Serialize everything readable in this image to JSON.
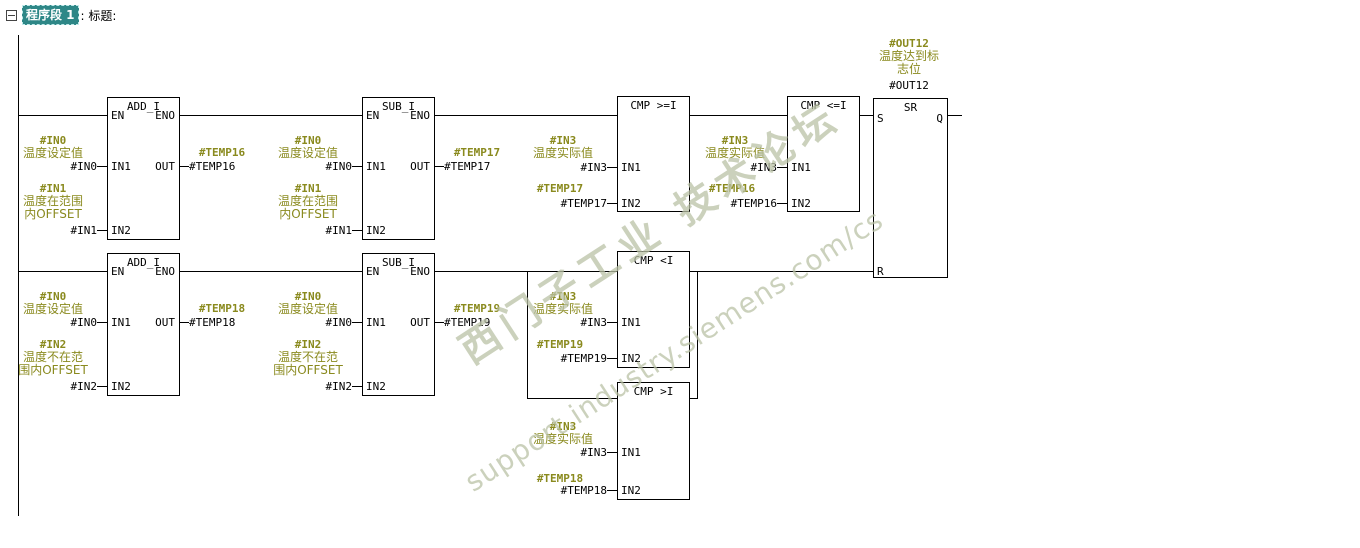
{
  "header": {
    "collapse_icon": "minus-box-icon",
    "network_label": "程序段 1",
    "suffix": ": 标题:"
  },
  "watermark": {
    "line1": "西门子工业 技术论坛",
    "line2": "support.industry.siemens.com/cs",
    "color": "#BAC1A5"
  },
  "colors": {
    "symbol_text": "#8A8A1E",
    "operand_text": "#000000",
    "wire": "#000000",
    "selection_bg": "#2E8787",
    "background": "#FFFFFF"
  },
  "diagram": {
    "blocks": [
      {
        "name": "add-i-1",
        "title": "ADD_I",
        "x": 107,
        "y": 97,
        "w": 73,
        "h": 143,
        "pins": [
          {
            "t": "EN",
            "s": "l",
            "y": 115
          },
          {
            "t": "ENO",
            "s": "r",
            "y": 115
          },
          {
            "t": "IN1",
            "s": "l",
            "y": 166
          },
          {
            "t": "IN2",
            "s": "l",
            "y": 230
          },
          {
            "t": "OUT",
            "s": "r",
            "y": 166
          }
        ]
      },
      {
        "name": "sub-i-1",
        "title": "SUB_I",
        "x": 362,
        "y": 97,
        "w": 73,
        "h": 143,
        "pins": [
          {
            "t": "EN",
            "s": "l",
            "y": 115
          },
          {
            "t": "ENO",
            "s": "r",
            "y": 115
          },
          {
            "t": "IN1",
            "s": "l",
            "y": 166
          },
          {
            "t": "IN2",
            "s": "l",
            "y": 230
          },
          {
            "t": "OUT",
            "s": "r",
            "y": 166
          }
        ]
      },
      {
        "name": "cmp-ge-i",
        "title": "CMP >=I",
        "x": 617,
        "y": 96,
        "w": 73,
        "h": 116,
        "pins": [
          {
            "t": "IN1",
            "s": "l",
            "y": 167
          },
          {
            "t": "IN2",
            "s": "l",
            "y": 203
          }
        ]
      },
      {
        "name": "cmp-le-i",
        "title": "CMP <=I",
        "x": 787,
        "y": 96,
        "w": 73,
        "h": 116,
        "pins": [
          {
            "t": "IN1",
            "s": "l",
            "y": 167
          },
          {
            "t": "IN2",
            "s": "l",
            "y": 203
          }
        ]
      },
      {
        "name": "sr-flipflop",
        "title": "SR",
        "x": 873,
        "y": 98,
        "w": 75,
        "h": 180,
        "pins": [
          {
            "t": "S",
            "s": "l",
            "y": 118
          },
          {
            "t": "Q",
            "s": "r",
            "y": 118
          },
          {
            "t": "R",
            "s": "l",
            "y": 271
          }
        ]
      },
      {
        "name": "add-i-2",
        "title": "ADD_I",
        "x": 107,
        "y": 253,
        "w": 73,
        "h": 143,
        "pins": [
          {
            "t": "EN",
            "s": "l",
            "y": 271
          },
          {
            "t": "ENO",
            "s": "r",
            "y": 271
          },
          {
            "t": "IN1",
            "s": "l",
            "y": 322
          },
          {
            "t": "IN2",
            "s": "l",
            "y": 386
          },
          {
            "t": "OUT",
            "s": "r",
            "y": 322
          }
        ]
      },
      {
        "name": "sub-i-2",
        "title": "SUB_I",
        "x": 362,
        "y": 253,
        "w": 73,
        "h": 143,
        "pins": [
          {
            "t": "EN",
            "s": "l",
            "y": 271
          },
          {
            "t": "ENO",
            "s": "r",
            "y": 271
          },
          {
            "t": "IN1",
            "s": "l",
            "y": 322
          },
          {
            "t": "IN2",
            "s": "l",
            "y": 386
          },
          {
            "t": "OUT",
            "s": "r",
            "y": 322
          }
        ]
      },
      {
        "name": "cmp-lt-i",
        "title": "CMP <I",
        "x": 617,
        "y": 251,
        "w": 73,
        "h": 117,
        "pins": [
          {
            "t": "IN1",
            "s": "l",
            "y": 322
          },
          {
            "t": "IN2",
            "s": "l",
            "y": 358
          }
        ]
      },
      {
        "name": "cmp-gt-i",
        "title": "CMP >I",
        "x": 617,
        "y": 382,
        "w": 73,
        "h": 118,
        "pins": [
          {
            "t": "IN1",
            "s": "l",
            "y": 452
          },
          {
            "t": "IN2",
            "s": "l",
            "y": 490
          }
        ]
      }
    ],
    "wires": [
      {
        "x": 18,
        "y": 35,
        "dir": "v",
        "len": 481
      },
      {
        "x": 18,
        "y": 115,
        "dir": "h",
        "len": 89
      },
      {
        "x": 180,
        "y": 115,
        "dir": "h",
        "len": 182
      },
      {
        "x": 435,
        "y": 115,
        "dir": "h",
        "len": 182
      },
      {
        "x": 690,
        "y": 115,
        "dir": "h",
        "len": 97
      },
      {
        "x": 860,
        "y": 115,
        "dir": "h",
        "len": 13
      },
      {
        "x": 948,
        "y": 115,
        "dir": "h",
        "len": 14
      },
      {
        "x": 18,
        "y": 271,
        "dir": "h",
        "len": 89
      },
      {
        "x": 180,
        "y": 271,
        "dir": "h",
        "len": 182
      },
      {
        "x": 435,
        "y": 271,
        "dir": "h",
        "len": 182
      },
      {
        "x": 527,
        "y": 271,
        "dir": "v",
        "len": 127
      },
      {
        "x": 527,
        "y": 398,
        "dir": "h",
        "len": 90
      },
      {
        "x": 690,
        "y": 271,
        "dir": "h",
        "len": 183
      },
      {
        "x": 697,
        "y": 271,
        "dir": "v",
        "len": 127
      },
      {
        "x": 690,
        "y": 398,
        "dir": "h",
        "len": 8
      },
      {
        "x": 97,
        "y": 166,
        "dir": "h",
        "len": 10
      },
      {
        "x": 97,
        "y": 230,
        "dir": "h",
        "len": 10
      },
      {
        "x": 180,
        "y": 166,
        "dir": "h",
        "len": 9
      },
      {
        "x": 352,
        "y": 166,
        "dir": "h",
        "len": 10
      },
      {
        "x": 352,
        "y": 230,
        "dir": "h",
        "len": 10
      },
      {
        "x": 435,
        "y": 166,
        "dir": "h",
        "len": 9
      },
      {
        "x": 607,
        "y": 167,
        "dir": "h",
        "len": 10
      },
      {
        "x": 607,
        "y": 203,
        "dir": "h",
        "len": 10
      },
      {
        "x": 777,
        "y": 167,
        "dir": "h",
        "len": 10
      },
      {
        "x": 777,
        "y": 203,
        "dir": "h",
        "len": 10
      },
      {
        "x": 97,
        "y": 322,
        "dir": "h",
        "len": 10
      },
      {
        "x": 97,
        "y": 386,
        "dir": "h",
        "len": 10
      },
      {
        "x": 180,
        "y": 322,
        "dir": "h",
        "len": 9
      },
      {
        "x": 352,
        "y": 322,
        "dir": "h",
        "len": 10
      },
      {
        "x": 352,
        "y": 386,
        "dir": "h",
        "len": 10
      },
      {
        "x": 435,
        "y": 322,
        "dir": "h",
        "len": 9
      },
      {
        "x": 607,
        "y": 322,
        "dir": "h",
        "len": 10
      },
      {
        "x": 607,
        "y": 358,
        "dir": "h",
        "len": 10
      },
      {
        "x": 607,
        "y": 452,
        "dir": "h",
        "len": 10
      },
      {
        "x": 607,
        "y": 490,
        "dir": "h",
        "len": 10
      }
    ],
    "texts": [
      {
        "t": "#IN0",
        "x": 53,
        "y": 134,
        "a": "c",
        "c": "s"
      },
      {
        "t": "温度设定值",
        "x": 53,
        "y": 147,
        "a": "c",
        "c": "s"
      },
      {
        "t": "#IN0",
        "x": 97,
        "y": 160,
        "a": "r",
        "c": "o"
      },
      {
        "t": "#IN1",
        "x": 53,
        "y": 182,
        "a": "c",
        "c": "s"
      },
      {
        "t": "温度在范围",
        "x": 53,
        "y": 195,
        "a": "c",
        "c": "s"
      },
      {
        "t": "内OFFSET",
        "x": 53,
        "y": 208,
        "a": "c",
        "c": "s"
      },
      {
        "t": "#IN1",
        "x": 97,
        "y": 224,
        "a": "r",
        "c": "o"
      },
      {
        "t": "#TEMP16",
        "x": 222,
        "y": 146,
        "a": "c",
        "c": "s"
      },
      {
        "t": "#TEMP16",
        "x": 189,
        "y": 160,
        "a": "l",
        "c": "o"
      },
      {
        "t": "#IN0",
        "x": 308,
        "y": 134,
        "a": "c",
        "c": "s"
      },
      {
        "t": "温度设定值",
        "x": 308,
        "y": 147,
        "a": "c",
        "c": "s"
      },
      {
        "t": "#IN0",
        "x": 352,
        "y": 160,
        "a": "r",
        "c": "o"
      },
      {
        "t": "#IN1",
        "x": 308,
        "y": 182,
        "a": "c",
        "c": "s"
      },
      {
        "t": "温度在范围",
        "x": 308,
        "y": 195,
        "a": "c",
        "c": "s"
      },
      {
        "t": "内OFFSET",
        "x": 308,
        "y": 208,
        "a": "c",
        "c": "s"
      },
      {
        "t": "#IN1",
        "x": 352,
        "y": 224,
        "a": "r",
        "c": "o"
      },
      {
        "t": "#TEMP17",
        "x": 477,
        "y": 146,
        "a": "c",
        "c": "s"
      },
      {
        "t": "#TEMP17",
        "x": 444,
        "y": 160,
        "a": "l",
        "c": "o"
      },
      {
        "t": "#IN3",
        "x": 563,
        "y": 134,
        "a": "c",
        "c": "s"
      },
      {
        "t": "温度实际值",
        "x": 563,
        "y": 147,
        "a": "c",
        "c": "s"
      },
      {
        "t": "#IN3",
        "x": 607,
        "y": 161,
        "a": "r",
        "c": "o"
      },
      {
        "t": "#TEMP17",
        "x": 560,
        "y": 182,
        "a": "c",
        "c": "s"
      },
      {
        "t": "#TEMP17",
        "x": 607,
        "y": 197,
        "a": "r",
        "c": "o"
      },
      {
        "t": "#IN3",
        "x": 735,
        "y": 134,
        "a": "c",
        "c": "s"
      },
      {
        "t": "温度实际值",
        "x": 735,
        "y": 147,
        "a": "c",
        "c": "s"
      },
      {
        "t": "#IN3",
        "x": 777,
        "y": 161,
        "a": "r",
        "c": "o"
      },
      {
        "t": "#TEMP16",
        "x": 732,
        "y": 182,
        "a": "c",
        "c": "s"
      },
      {
        "t": "#TEMP16",
        "x": 777,
        "y": 197,
        "a": "r",
        "c": "o"
      },
      {
        "t": "#OUT12",
        "x": 909,
        "y": 37,
        "a": "c",
        "c": "s"
      },
      {
        "t": "温度达到标",
        "x": 909,
        "y": 50,
        "a": "c",
        "c": "s"
      },
      {
        "t": "志位",
        "x": 909,
        "y": 63,
        "a": "c",
        "c": "s"
      },
      {
        "t": "#OUT12",
        "x": 909,
        "y": 79,
        "a": "c",
        "c": "o"
      },
      {
        "t": "#IN0",
        "x": 53,
        "y": 290,
        "a": "c",
        "c": "s"
      },
      {
        "t": "温度设定值",
        "x": 53,
        "y": 303,
        "a": "c",
        "c": "s"
      },
      {
        "t": "#IN0",
        "x": 97,
        "y": 316,
        "a": "r",
        "c": "o"
      },
      {
        "t": "#IN2",
        "x": 53,
        "y": 338,
        "a": "c",
        "c": "s"
      },
      {
        "t": "温度不在范",
        "x": 53,
        "y": 351,
        "a": "c",
        "c": "s"
      },
      {
        "t": "围内OFFSET",
        "x": 53,
        "y": 364,
        "a": "c",
        "c": "s"
      },
      {
        "t": "#IN2",
        "x": 97,
        "y": 380,
        "a": "r",
        "c": "o"
      },
      {
        "t": "#TEMP18",
        "x": 222,
        "y": 302,
        "a": "c",
        "c": "s"
      },
      {
        "t": "#TEMP18",
        "x": 189,
        "y": 316,
        "a": "l",
        "c": "o"
      },
      {
        "t": "#IN0",
        "x": 308,
        "y": 290,
        "a": "c",
        "c": "s"
      },
      {
        "t": "温度设定值",
        "x": 308,
        "y": 303,
        "a": "c",
        "c": "s"
      },
      {
        "t": "#IN0",
        "x": 352,
        "y": 316,
        "a": "r",
        "c": "o"
      },
      {
        "t": "#IN2",
        "x": 308,
        "y": 338,
        "a": "c",
        "c": "s"
      },
      {
        "t": "温度不在范",
        "x": 308,
        "y": 351,
        "a": "c",
        "c": "s"
      },
      {
        "t": "围内OFFSET",
        "x": 308,
        "y": 364,
        "a": "c",
        "c": "s"
      },
      {
        "t": "#IN2",
        "x": 352,
        "y": 380,
        "a": "r",
        "c": "o"
      },
      {
        "t": "#TEMP19",
        "x": 477,
        "y": 302,
        "a": "c",
        "c": "s"
      },
      {
        "t": "#TEMP19",
        "x": 444,
        "y": 316,
        "a": "l",
        "c": "o"
      },
      {
        "t": "#IN3",
        "x": 563,
        "y": 290,
        "a": "c",
        "c": "s"
      },
      {
        "t": "温度实际值",
        "x": 563,
        "y": 303,
        "a": "c",
        "c": "s"
      },
      {
        "t": "#IN3",
        "x": 607,
        "y": 316,
        "a": "r",
        "c": "o"
      },
      {
        "t": "#TEMP19",
        "x": 560,
        "y": 338,
        "a": "c",
        "c": "s"
      },
      {
        "t": "#TEMP19",
        "x": 607,
        "y": 352,
        "a": "r",
        "c": "o"
      },
      {
        "t": "#IN3",
        "x": 563,
        "y": 420,
        "a": "c",
        "c": "s"
      },
      {
        "t": "温度实际值",
        "x": 563,
        "y": 433,
        "a": "c",
        "c": "s"
      },
      {
        "t": "#IN3",
        "x": 607,
        "y": 446,
        "a": "r",
        "c": "o"
      },
      {
        "t": "#TEMP18",
        "x": 560,
        "y": 472,
        "a": "c",
        "c": "s"
      },
      {
        "t": "#TEMP18",
        "x": 607,
        "y": 484,
        "a": "r",
        "c": "o"
      }
    ]
  }
}
